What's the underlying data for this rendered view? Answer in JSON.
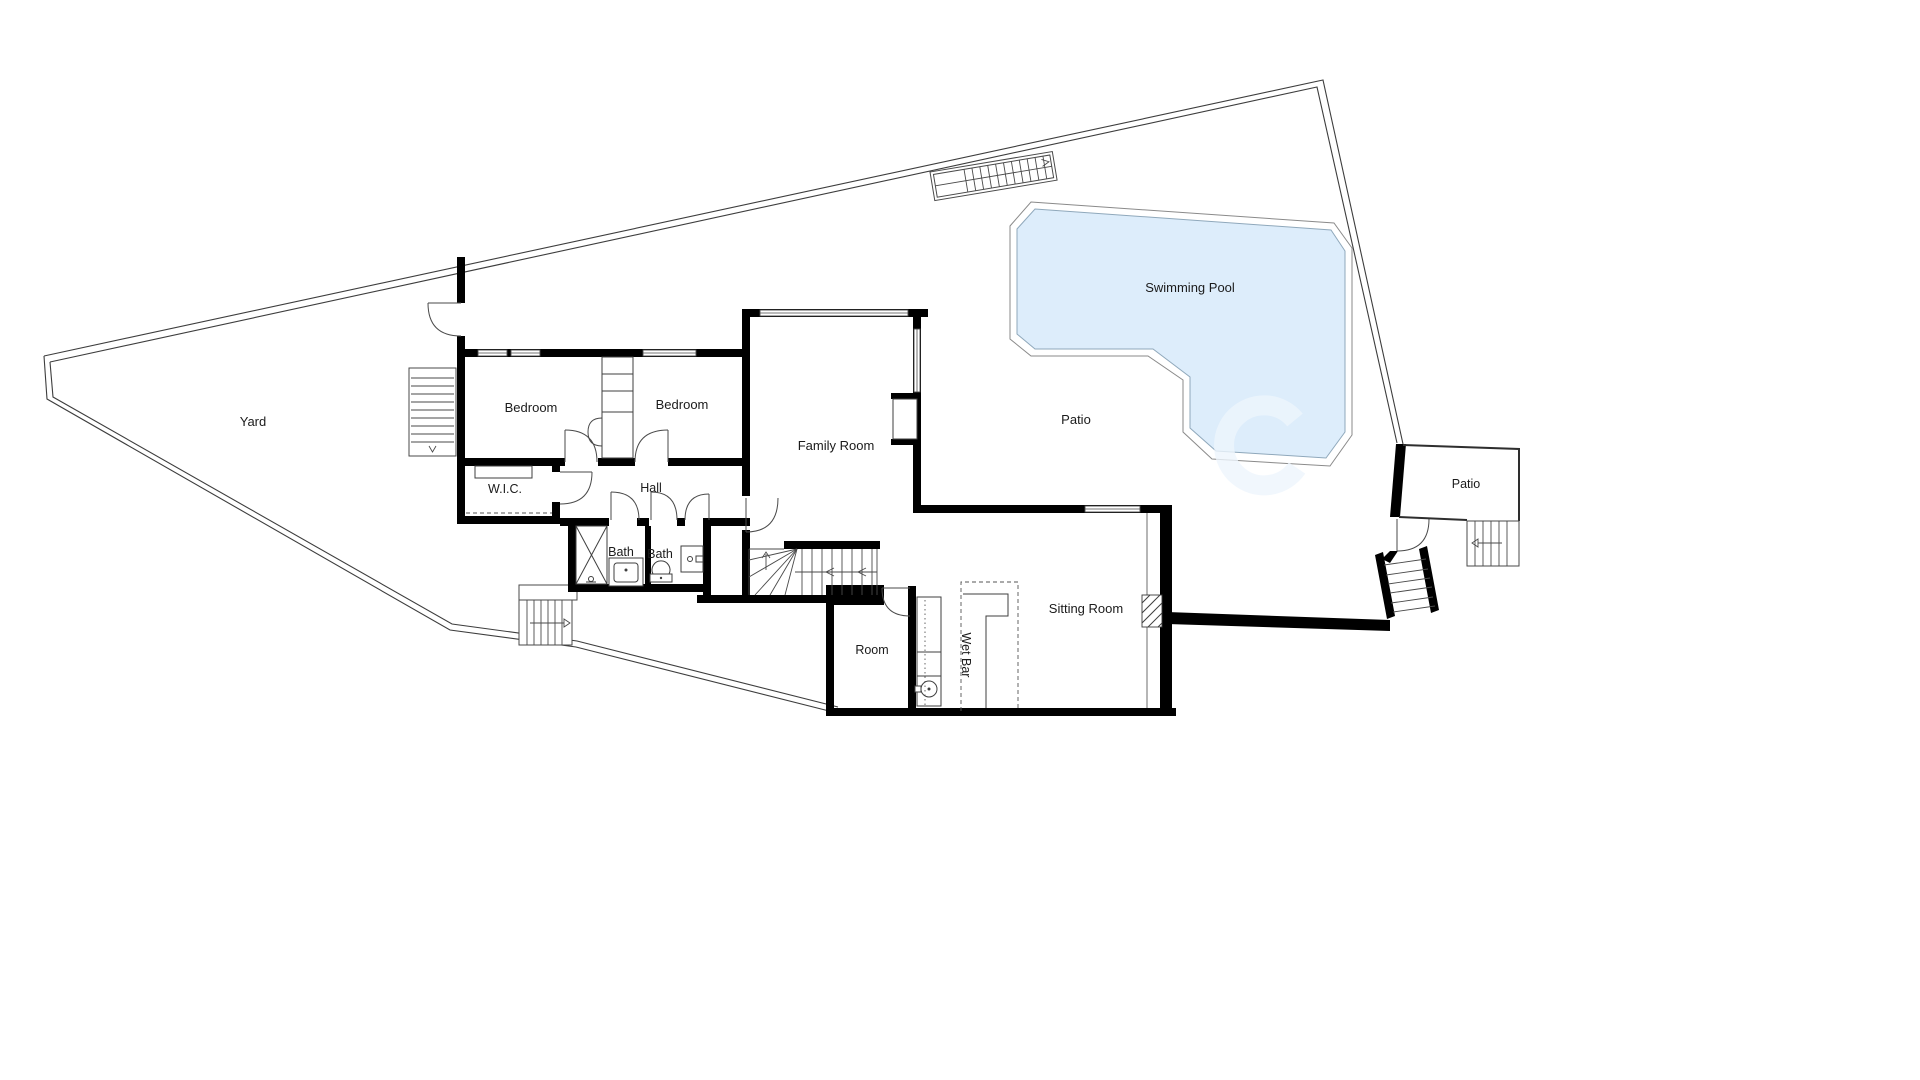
{
  "plan": {
    "rooms": {
      "yard": {
        "label": "Yard"
      },
      "bedroom_left": {
        "label": "Bedroom"
      },
      "bedroom_right": {
        "label": "Bedroom"
      },
      "wic": {
        "label": "W.I.C."
      },
      "hall": {
        "label": "Hall"
      },
      "bath_left": {
        "label": "Bath"
      },
      "bath_right": {
        "label": "Bath"
      },
      "family_room": {
        "label": "Family Room"
      },
      "swimming_pool": {
        "label": "Swimming Pool"
      },
      "patio_main": {
        "label": "Patio"
      },
      "patio_right": {
        "label": "Patio"
      },
      "sitting_room": {
        "label": "Sitting Room"
      },
      "room": {
        "label": "Room"
      },
      "wet_bar": {
        "label": "Wet Bar"
      }
    },
    "colors": {
      "wall": "#000000",
      "pool_fill": "#ddedfb",
      "pool_edge": "#8fa8bb",
      "label": "#1b1b1b"
    }
  }
}
